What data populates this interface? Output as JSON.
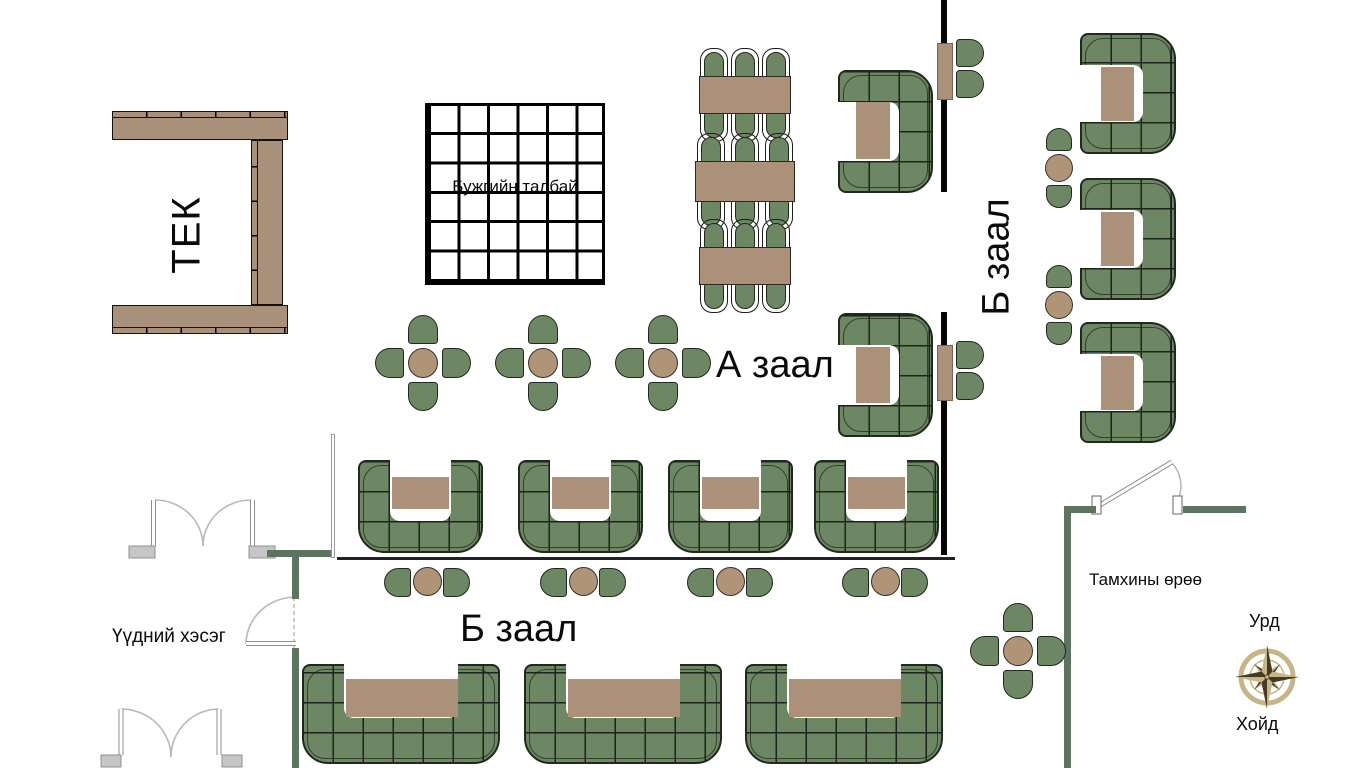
{
  "labels": {
    "stage": "ТЕК",
    "dance_floor": "Бужгийн талбай",
    "hall_a": "А заал",
    "hall_b_right": "Б заал",
    "hall_b_bottom": "Б заал",
    "entrance": "Үүдний хэсэг",
    "smoking_room": "Тамхины өрөө",
    "compass_front": "Урд",
    "compass_back": "Хойд"
  },
  "colors": {
    "sofa_green": "#6d8765",
    "outline_dark": "#1f2a1c",
    "table_brown": "#ab9179",
    "wall_black": "#060606",
    "wall_green": "#5d7560",
    "door_gray": "#c6c6c6",
    "compass_tan": "#c7b58a",
    "compass_dark": "#453a22"
  },
  "floorplan": {
    "walls_black": [
      [
        941,
        0,
        6,
        192
      ],
      [
        941,
        312,
        6,
        243
      ]
    ],
    "walls_green": [
      [
        267,
        550,
        68,
        7
      ],
      [
        292,
        557,
        7,
        42
      ],
      [
        292,
        648,
        7,
        120
      ],
      [
        1064,
        506,
        32,
        7
      ],
      [
        1183,
        506,
        63,
        7
      ],
      [
        1064,
        506,
        7,
        262
      ]
    ],
    "walls_thin": [
      [
        337,
        557,
        618,
        3
      ]
    ],
    "walls_thin_light": [
      [
        331,
        434,
        4,
        124
      ]
    ],
    "stage_bars": [
      {
        "x": 112,
        "y": 117,
        "w": 176,
        "h": 23,
        "strip": "top"
      },
      {
        "x": 112,
        "y": 305,
        "w": 176,
        "h": 23,
        "strip": "bottom"
      },
      {
        "x": 257,
        "y": 140,
        "w": 26,
        "h": 165,
        "strip": "left"
      }
    ],
    "dance_floor": {
      "x": 425,
      "y": 103,
      "w": 180,
      "h": 182
    },
    "rect_tables": [
      {
        "x": 699,
        "y": 76,
        "w": 92,
        "h": 38
      },
      {
        "x": 695,
        "y": 161,
        "w": 100,
        "h": 41
      },
      {
        "x": 699,
        "y": 247,
        "w": 92,
        "h": 38
      }
    ],
    "booths": [
      {
        "x": 838,
        "y": 70,
        "w": 95,
        "h": 123,
        "open": "left",
        "aw": 32,
        "bt": 34,
        "table": [
          18,
          32,
          34,
          57
        ]
      },
      {
        "x": 838,
        "y": 313,
        "w": 95,
        "h": 124,
        "open": "left",
        "aw": 32,
        "bt": 34,
        "table": [
          18,
          34,
          34,
          56
        ]
      },
      {
        "x": 358,
        "y": 460,
        "w": 125,
        "h": 93,
        "open": "up",
        "aw": 32,
        "bt": 32,
        "table": [
          34,
          17,
          57,
          32
        ]
      },
      {
        "x": 518,
        "y": 460,
        "w": 125,
        "h": 93,
        "open": "up",
        "aw": 32,
        "bt": 32,
        "table": [
          34,
          17,
          57,
          32
        ]
      },
      {
        "x": 668,
        "y": 460,
        "w": 125,
        "h": 93,
        "open": "up",
        "aw": 32,
        "bt": 32,
        "table": [
          34,
          17,
          57,
          32
        ]
      },
      {
        "x": 814,
        "y": 460,
        "w": 125,
        "h": 93,
        "open": "up",
        "aw": 32,
        "bt": 32,
        "table": [
          34,
          17,
          57,
          32
        ]
      },
      {
        "x": 302,
        "y": 664,
        "w": 198,
        "h": 100,
        "open": "up",
        "aw": 42,
        "bt": 46,
        "table": [
          44,
          15,
          112,
          38
        ]
      },
      {
        "x": 524,
        "y": 664,
        "w": 198,
        "h": 100,
        "open": "up",
        "aw": 42,
        "bt": 46,
        "table": [
          44,
          15,
          112,
          38
        ]
      },
      {
        "x": 745,
        "y": 664,
        "w": 198,
        "h": 100,
        "open": "up",
        "aw": 42,
        "bt": 46,
        "table": [
          44,
          15,
          112,
          38
        ]
      },
      {
        "x": 1080,
        "y": 33,
        "w": 96,
        "h": 121,
        "open": "left",
        "aw": 32,
        "bt": 33,
        "table": [
          21,
          34,
          33,
          54
        ]
      },
      {
        "x": 1080,
        "y": 178,
        "w": 96,
        "h": 122,
        "open": "left",
        "aw": 32,
        "bt": 33,
        "table": [
          21,
          34,
          33,
          54
        ]
      },
      {
        "x": 1080,
        "y": 322,
        "w": 96,
        "h": 121,
        "open": "left",
        "aw": 32,
        "bt": 33,
        "table": [
          21,
          34,
          33,
          54
        ]
      }
    ],
    "cross_tables": [
      {
        "cx": 423,
        "cy": 363
      },
      {
        "cx": 543,
        "cy": 363
      },
      {
        "cx": 663,
        "cy": 363
      },
      {
        "cx": 1018,
        "cy": 651
      }
    ],
    "round_groups_h": [
      {
        "cx": 427,
        "cy": 582
      },
      {
        "cx": 583,
        "cy": 582
      },
      {
        "cx": 730,
        "cy": 582
      },
      {
        "cx": 885,
        "cy": 582
      }
    ],
    "round_groups_v": [
      {
        "cx": 1059,
        "cy": 168
      },
      {
        "cx": 1059,
        "cy": 305
      }
    ],
    "wall_tables": [
      {
        "x": 937,
        "y": 43,
        "w": 16,
        "h": 57
      },
      {
        "x": 937,
        "y": 345,
        "w": 16,
        "h": 56
      }
    ]
  }
}
